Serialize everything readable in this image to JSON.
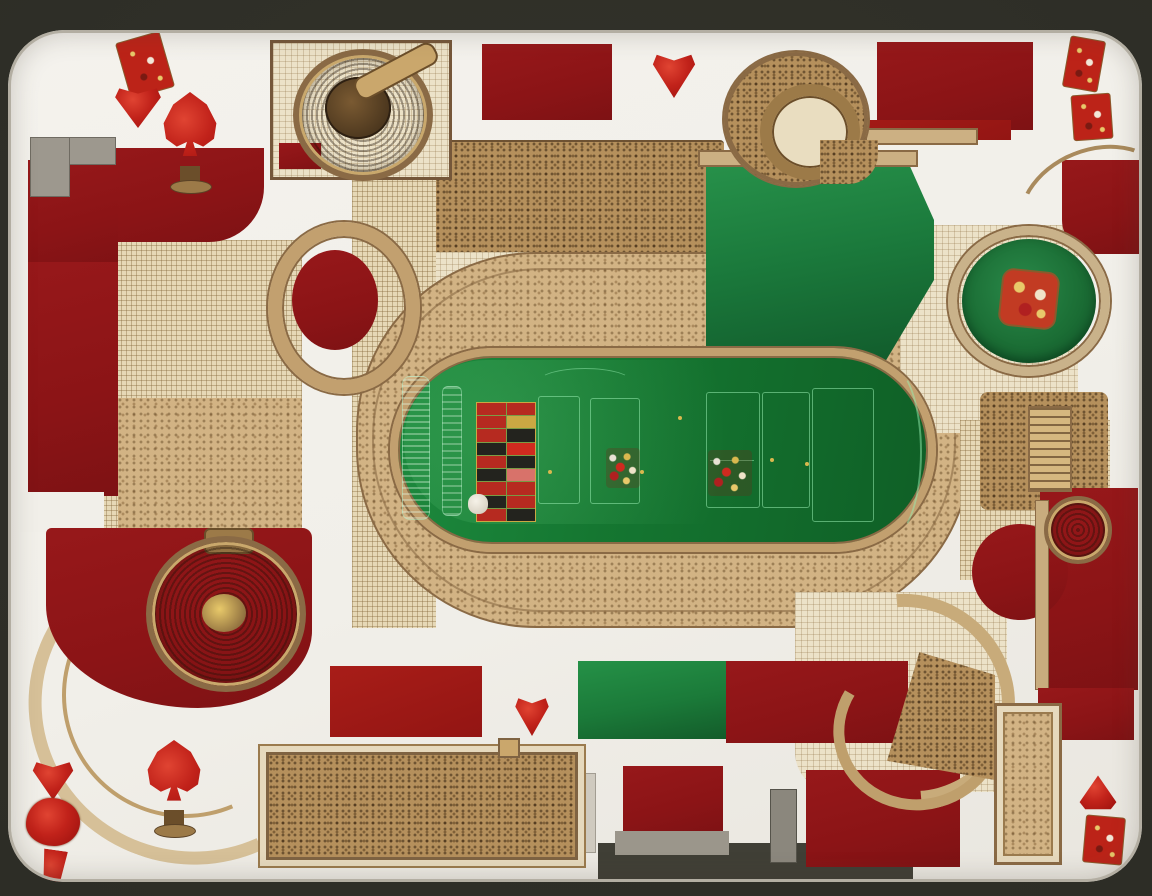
{
  "scene": {
    "title": "Ornate casino floor plan drawn as a playing card",
    "view": "top-down architectural plan",
    "background_color": "#2f2f27",
    "card_color": "#f2f0ea",
    "legible_text": "none (decorative gibberish only)"
  },
  "palette": {
    "dark_red": "#8b1416",
    "bright_red": "#c1221a",
    "felt_green": "#15722f",
    "flat_green": "#1f7a3a",
    "tan_light": "#ece2c8",
    "tan_mosaic": "#c9a878",
    "tan_dark": "#8a6a45",
    "gold": "#b08948",
    "gray": "#9a958c",
    "frame_dark": "#30302a"
  },
  "playing_card": {
    "corner_marks": [
      {
        "id": "top-left-index",
        "type": "ornate-index-bar",
        "corner": "top-left"
      },
      {
        "id": "top-left-heart",
        "type": "heart",
        "corner": "top-left"
      },
      {
        "id": "top-left-spade",
        "type": "ornate-spade-on-pedestal",
        "corner": "top-left"
      },
      {
        "id": "top-center-heart",
        "type": "heart",
        "corner": "top-center"
      },
      {
        "id": "top-right-index",
        "type": "ornate-index-two-piece",
        "corner": "top-right"
      },
      {
        "id": "bottom-left-totem",
        "type": "stacked-heart-totem",
        "corner": "bottom-left"
      },
      {
        "id": "bottom-left-spade",
        "type": "ornate-spade-on-pedestal",
        "corner": "bottom-left"
      },
      {
        "id": "bottom-center-heart",
        "type": "heart",
        "corner": "bottom-center"
      },
      {
        "id": "bottom-right-triangle",
        "type": "heart-triangle",
        "corner": "bottom-right"
      },
      {
        "id": "bottom-right-index",
        "type": "ornate-index-bar",
        "corner": "bottom-right"
      }
    ]
  },
  "floor_plan": {
    "features": [
      "ornate compass rosette room (top-left)",
      "pebble-mosaic promenade (top)",
      "spiral stair structure (top-right)",
      "green salon (upper-right)",
      "round roulette table with ornate centerpiece (right)",
      "central craps/roulette table on mosaic apron (center)",
      "circular stair with red core (mid-left)",
      "grand medallion rotunda on red carpet (bottom-left)",
      "bordered mosaic hall (bottom-center)",
      "fan staircase structure (bottom-right)",
      "red salon blocks (perimeter)",
      "small ornate medallion and ladder block (right)"
    ]
  },
  "craps_table": {
    "felt_color": "#15722f",
    "rim_color": "#c2a06f",
    "betting_grid": {
      "rows": 9,
      "cols": 2,
      "cells": [
        [
          "#b62a20",
          "#b62a20"
        ],
        [
          "#b62a20",
          "#caa843"
        ],
        [
          "#b62a20",
          "#23231e"
        ],
        [
          "#23231e",
          "#cf2a1f"
        ],
        [
          "#b62a20",
          "#23231e"
        ],
        [
          "#23231e",
          "#d8726a"
        ],
        [
          "#b62a20",
          "#b62a20"
        ],
        [
          "#23231e",
          "#b62a20"
        ],
        [
          "#b62a20",
          "#23231e"
        ]
      ]
    },
    "betting_boxes": [
      {
        "x": 148,
        "y": 48,
        "w": 40,
        "h": 106
      },
      {
        "x": 200,
        "y": 50,
        "w": 48,
        "h": 104
      },
      {
        "x": 316,
        "y": 44,
        "w": 52,
        "h": 114
      },
      {
        "x": 372,
        "y": 44,
        "w": 46,
        "h": 114
      },
      {
        "x": 422,
        "y": 40,
        "w": 60,
        "h": 132
      }
    ],
    "chip_clusters": [
      {
        "x": 216,
        "y": 100,
        "w": 34,
        "h": 40,
        "variant": "mixed"
      },
      {
        "x": 318,
        "y": 102,
        "w": 44,
        "h": 46,
        "variant": "mixed"
      },
      {
        "x": 78,
        "y": 146,
        "w": 20,
        "h": 20,
        "variant": "white"
      }
    ],
    "gold_specks": [
      [
        380,
        110
      ],
      [
        250,
        122
      ],
      [
        158,
        122
      ],
      [
        415,
        114
      ],
      [
        288,
        68
      ]
    ]
  },
  "round_table": {
    "felt_color": "#1b6e35",
    "rim_color": "#c9b28a",
    "centerpiece": "ornate red-gold square tile"
  }
}
